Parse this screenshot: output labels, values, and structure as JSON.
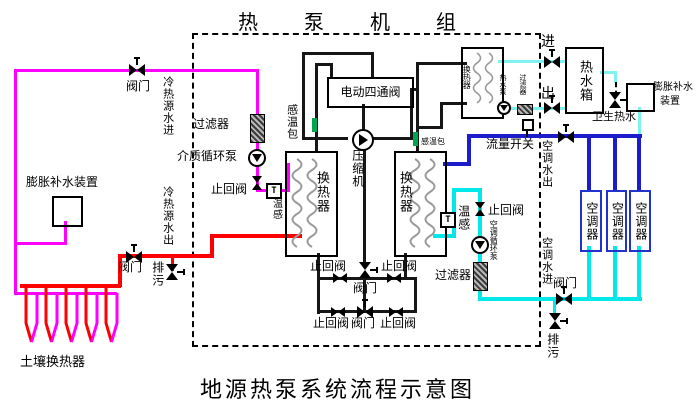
{
  "title": "热泵机组",
  "caption": "地源热泵系统流程示意图",
  "labels": {
    "valve": "阀门",
    "check_valve": "止回阀",
    "drain": "排污",
    "filter": "过滤器",
    "heat_exchanger": "换热器",
    "sensing_bulb": "感温包",
    "temp_sensor": "温感",
    "t_mark": "T",
    "source_water_in": "冷热源水进",
    "source_water_out": "冷热源水出",
    "expansion_device": "膨胀补水装置",
    "expansion_device_line1": "膨胀补水",
    "expansion_device_line2": "装置",
    "medium_pump": "介质循环泵",
    "four_way_valve": "电动四通阀",
    "compressor": "压缩机",
    "flow_switch": "流量开关",
    "water_in": "进",
    "water_out": "出",
    "hot_water_tank": "热水箱",
    "hot_water_pump": "热水泵",
    "sanitary_hot_water": "卫生热水",
    "ac_water_out": "空调水出",
    "ac_water_in": "空调水进",
    "ac_unit": "空调器",
    "ac_circulation_pump": "空调循环泵",
    "soil_heat_exchanger": "土壤换热器"
  },
  "colors": {
    "source_supply_pipe": "#ff00ff",
    "source_return_pipe": "#ff0000",
    "refrigerant_pipe": "#161616",
    "hot_water_pipe": "#7ef2f2",
    "ac_supply_pipe": "#1c1ccd",
    "ac_return_pipe": "#00e8e8",
    "sensing_bulb": "#00a651",
    "ac_unit_border": "#2233cc"
  }
}
